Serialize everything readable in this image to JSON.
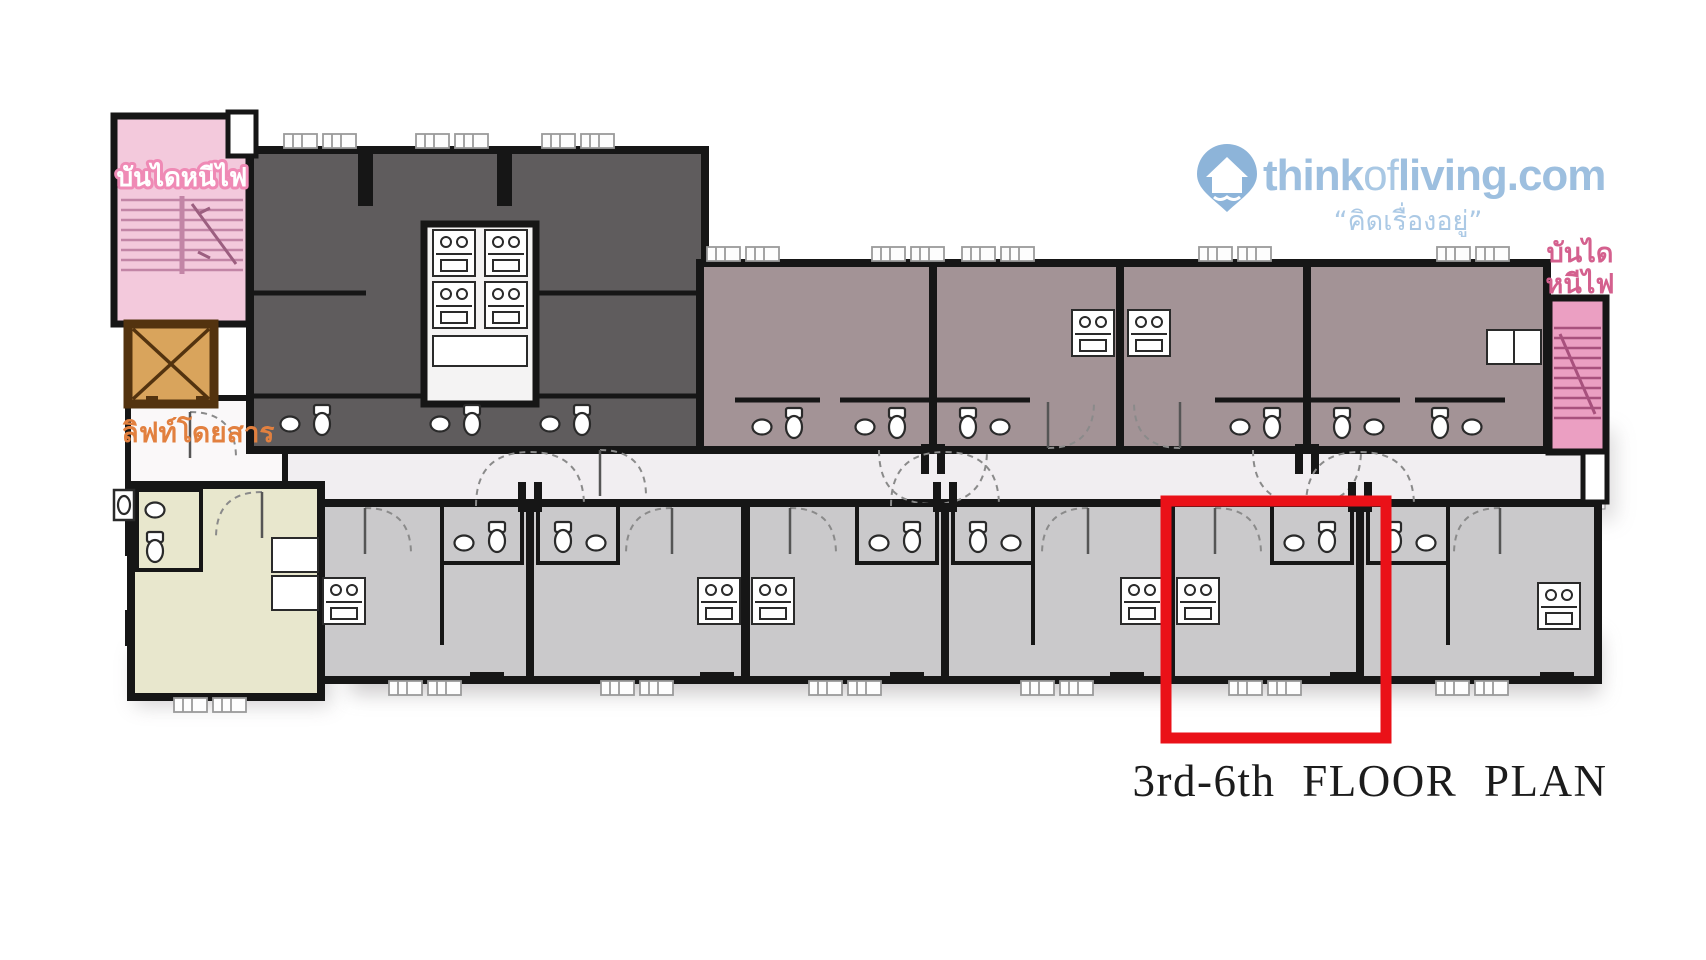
{
  "page": {
    "background_color": "#ffffff"
  },
  "branding": {
    "site_part_think": "think",
    "site_part_of": "of",
    "site_part_living": "living",
    "site_part_dotcom": ".com",
    "tagline": "“คิดเรื่องอยู่”",
    "icon": "map-pin-house",
    "color_primary": "#9dbfdf",
    "tagline_color": "#abc9e5"
  },
  "plan": {
    "title": "3rd-6th FLOOR PLAN",
    "title_color": "#1c1c1c",
    "labels": {
      "fire_escape_left": "บันไดหนีไฟ",
      "fire_escape_right_top": "บันได",
      "fire_escape_right_bottom": "หนีไฟ",
      "elevator": "ลิฟท์โดยสาร"
    },
    "highlight_color": "#ea1118"
  },
  "colors": {
    "wall": "#161616",
    "dark_units": "#5f5c5d",
    "mauve_units": "#a39396",
    "gray_units": "#cac9cb",
    "yellow_unit": "#e8e7cd",
    "corridor": "#f1eef1",
    "lobby": "#faf8f9",
    "stair_left_pink": "#f3c9dc",
    "stair_right_pink": "#eb9fc2",
    "stair_tread_pink": "#c285a6",
    "elevator_fill": "#d9a45c",
    "elevator_border": "#53330f",
    "elevator_label": "#e2803f",
    "stair_label_pink": "#d4608e"
  }
}
